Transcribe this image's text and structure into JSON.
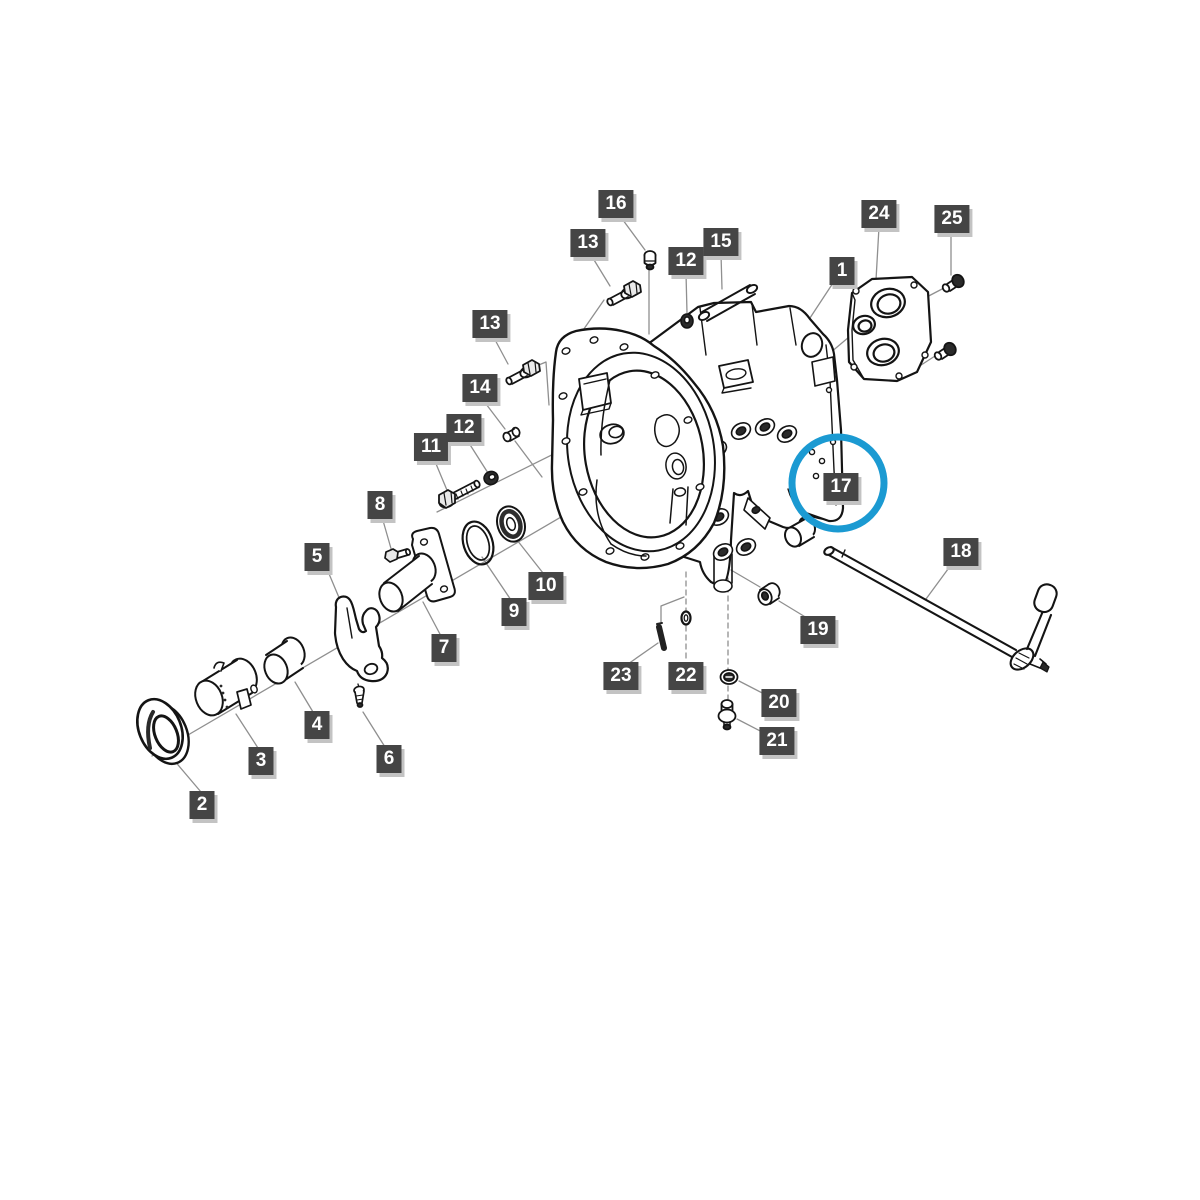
{
  "canvas": {
    "width": 1200,
    "height": 1200,
    "background": "#ffffff"
  },
  "diagram": {
    "kind": "exploded-parts-illustration",
    "line_color": "#141414",
    "leader_color": "#8f8f8f",
    "label_style": {
      "background": "#454545",
      "text": "#ffffff",
      "shadow": "#c3c3c3"
    },
    "highlight": {
      "label": "17",
      "shape": "circle",
      "color": "#1b9ad2",
      "cx": 838,
      "cy": 483,
      "r": 46,
      "stroke_width": 7
    },
    "labels": [
      {
        "n": "1",
        "x": 842,
        "y": 271
      },
      {
        "n": "2",
        "x": 202,
        "y": 805
      },
      {
        "n": "3",
        "x": 261,
        "y": 761
      },
      {
        "n": "4",
        "x": 317,
        "y": 725
      },
      {
        "n": "5",
        "x": 317,
        "y": 557
      },
      {
        "n": "6",
        "x": 389,
        "y": 759
      },
      {
        "n": "7",
        "x": 444,
        "y": 648
      },
      {
        "n": "8",
        "x": 380,
        "y": 505
      },
      {
        "n": "9",
        "x": 514,
        "y": 612
      },
      {
        "n": "10",
        "x": 546,
        "y": 586
      },
      {
        "n": "11",
        "x": 431,
        "y": 447
      },
      {
        "n": "12",
        "x": 686,
        "y": 261
      },
      {
        "n": "12",
        "x": 464,
        "y": 428
      },
      {
        "n": "13",
        "x": 588,
        "y": 243
      },
      {
        "n": "13",
        "x": 490,
        "y": 324
      },
      {
        "n": "14",
        "x": 480,
        "y": 388
      },
      {
        "n": "15",
        "x": 721,
        "y": 242
      },
      {
        "n": "16",
        "x": 616,
        "y": 204
      },
      {
        "n": "17",
        "x": 841,
        "y": 487
      },
      {
        "n": "18",
        "x": 961,
        "y": 552
      },
      {
        "n": "19",
        "x": 818,
        "y": 630
      },
      {
        "n": "20",
        "x": 779,
        "y": 703
      },
      {
        "n": "21",
        "x": 777,
        "y": 741
      },
      {
        "n": "22",
        "x": 686,
        "y": 676
      },
      {
        "n": "23",
        "x": 621,
        "y": 676
      },
      {
        "n": "24",
        "x": 879,
        "y": 214
      },
      {
        "n": "25",
        "x": 952,
        "y": 219
      }
    ]
  }
}
